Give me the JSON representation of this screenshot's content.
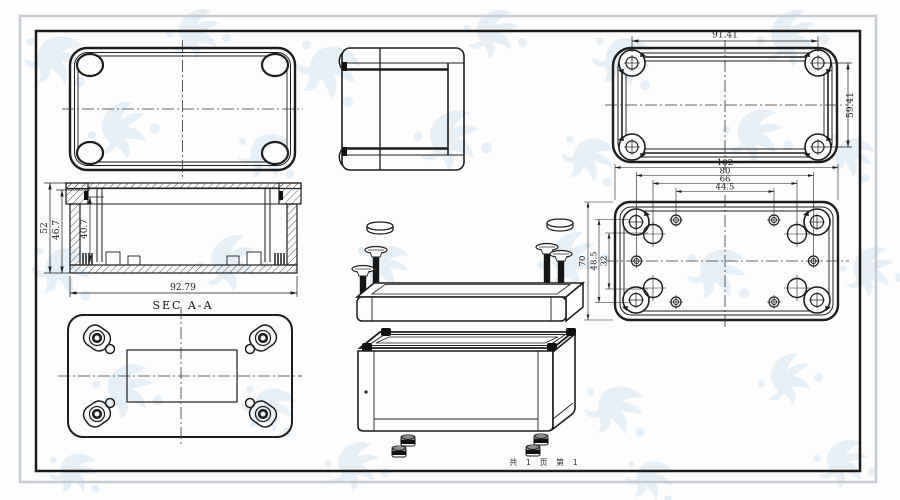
{
  "sheet": {
    "footer_text": "共 1 页  第 1"
  },
  "views": {
    "cover_inner": {
      "dim_width": "91.41",
      "dim_height": "59.41"
    },
    "section": {
      "label": "SEC A-A",
      "dim_total_height": "52",
      "dim_inner_height": "46.7",
      "dim_cavity_depth": "40.7",
      "dim_width": "92.79"
    },
    "base_inner": {
      "dim_h": [
        "102",
        "80",
        "66",
        "44.5"
      ],
      "dim_v": [
        "70",
        "48.5",
        "32"
      ]
    }
  }
}
